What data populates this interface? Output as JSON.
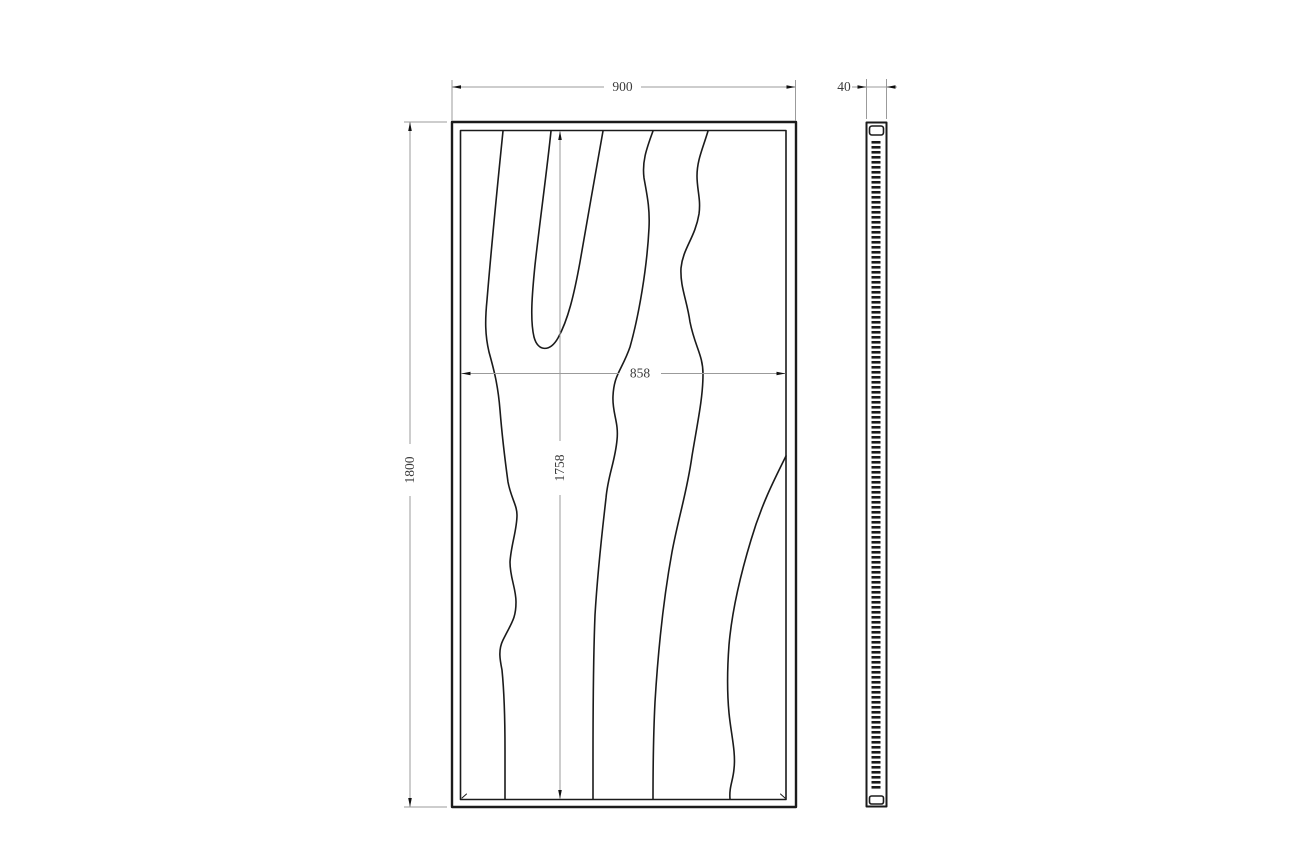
{
  "drawing": {
    "type": "technical-drawing",
    "subject": "framed wood-grain panel, front and side elevation",
    "views": {
      "front": {
        "name": "front-view",
        "dimensions": {
          "overall_width": {
            "value": 900,
            "label": "900"
          },
          "overall_height": {
            "value": 1800,
            "label": "1800"
          },
          "inner_width": {
            "value": 858,
            "label": "858"
          },
          "inner_height": {
            "value": 1758,
            "label": "1758"
          }
        }
      },
      "side": {
        "name": "side-view",
        "dimensions": {
          "thickness": {
            "value": 40,
            "label": "40"
          }
        }
      }
    },
    "colors": {
      "line": "#1b1b1b",
      "dimension_line": "#9b9b9b",
      "arrow": "#111111",
      "text": "#3c3c3c",
      "background": "#ffffff"
    }
  }
}
